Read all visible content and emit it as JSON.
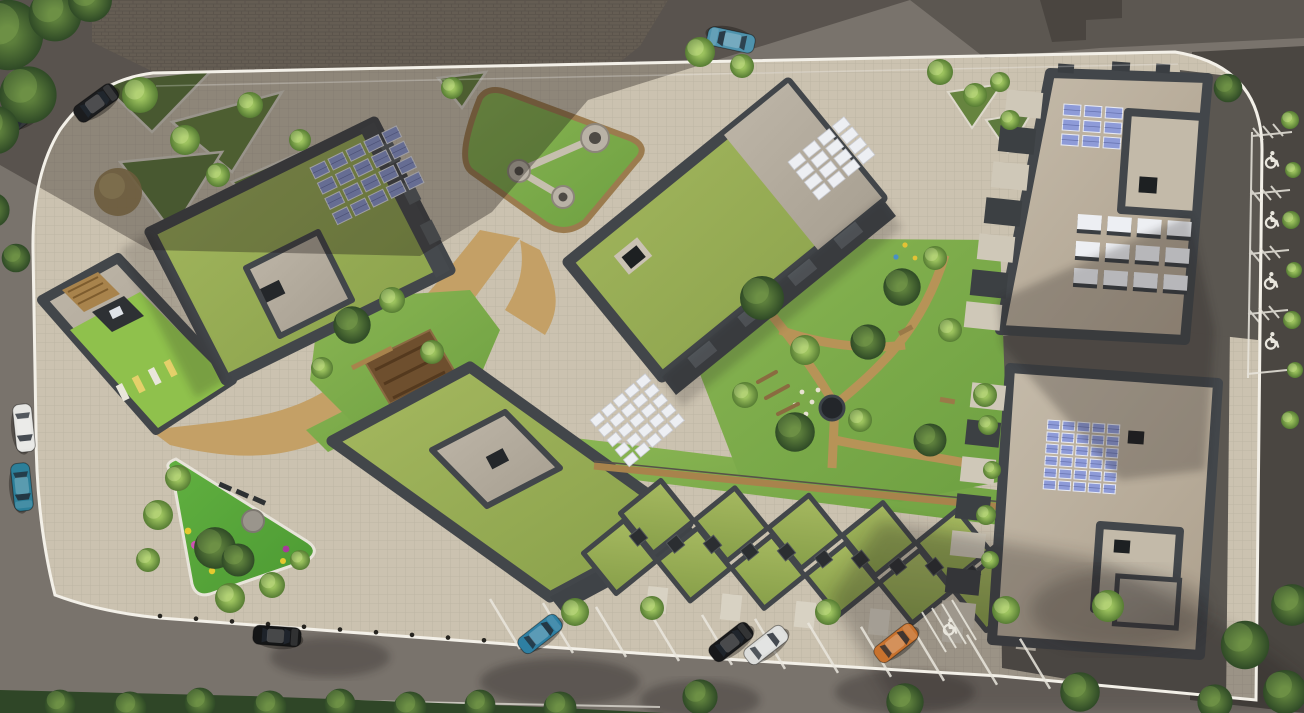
{
  "meta": {
    "title": "Top-down aerial rendering of a residential development site plan",
    "view": "orthographic top-down architectural visualization",
    "text_content": "none — image contains no readable text"
  },
  "palette": {
    "asphalt": "#79736c",
    "asphalt_dark": "#5b5751",
    "asphalt_deep": "#4a4641",
    "sidewalk_brick": "#8b8274",
    "plaza": "#cbc2b0",
    "parapet": "#42464a",
    "parapet_light": "#585d60",
    "path_tan": "#c4a066",
    "dirt": "#b08a52",
    "soil": "#6e4f2e",
    "wood": "#a8834c",
    "solar_blue": "#8e9bd8",
    "solar_frame": "#e6e9f4",
    "solar_white": "#edeff3",
    "white_line": "#eae7de",
    "boundary": "#f3f0e8",
    "hedge": "#2f4627",
    "flower_pink": "#cf52b5",
    "flower_magenta": "#a83a9a",
    "flower_yellow": "#e5c92f",
    "flower_lime": "#a6cf3a"
  },
  "scene": {
    "site": {
      "boundary_marking": "continuous white painted line around the parcel",
      "bollard_count": 11
    },
    "buildings": [
      {
        "name": "west-building",
        "roof": "extensive green roof",
        "solar_panels": "blue PV array 4x5",
        "extras": [
          "concrete roof courtyard with skylight",
          "roof terrace with timber deck",
          "lime lawn with 4 sun loungers"
        ]
      },
      {
        "name": "north-central-building",
        "roof": "green roof with concrete end bay",
        "solar_panels": "white PV array 4x4",
        "extras": [
          "black skylight",
          "balcony band on SE face"
        ]
      },
      {
        "name": "south-central-building",
        "roof": "green roof",
        "solar_panels": "white PV array 5x5",
        "extras": [
          "concrete roof courtyard with skylight"
        ]
      },
      {
        "name": "townhouse-row",
        "roof": "zigzag diamond green roofs",
        "units_upper": 6,
        "units_lower": 6,
        "extras": [
          "dark skylights at ridge joints",
          "timber boardwalk along rear"
        ]
      },
      {
        "name": "northeast-building",
        "roof": "concrete roof",
        "solar_panels": "blue PV array 3x3",
        "extras": [
          "rooftop monitor skylights 3x4",
          "penthouse volume with skylight",
          "balcony stack on west face"
        ]
      },
      {
        "name": "southeast-building",
        "roof": "concrete roof",
        "solar_panels": "blue PV array 6x5",
        "extras": [
          "penthouse volume with skylight",
          "balcony stack on west face"
        ]
      }
    ],
    "landscape": {
      "northwest_garden": "terraced planting beds with white edging and trees",
      "lawn_triangle": "rounded triangular lawn with three circular pads linked by paths",
      "central_garden": "informal play garden with dirt paths, log steps, benches and a sunken black trampoline",
      "community_garden": "raised soil planting beds with timber boardwalk",
      "playground_triangle": "bright green play triangle with pink/magenta/yellow/lime play dots, grey circle pad and benches",
      "street_greens": "tree islands in parking lane, hedge along south sidewalk, shrub strip along east kerb"
    },
    "parking": {
      "south_lane_stalls": 11,
      "accessible_spaces": 5,
      "marking_icon": "wheelchair-icon"
    },
    "cars": [
      {
        "name": "car-black-northwest",
        "x": 96,
        "y": 103,
        "angle": -36,
        "color": "#1b1c1e"
      },
      {
        "name": "car-gray-northwest",
        "x": 27,
        "y": 112,
        "angle": -36,
        "color": "#35383b"
      },
      {
        "name": "car-blue-north-road",
        "x": 731,
        "y": 40,
        "angle": -168,
        "color": "#4f93ad"
      },
      {
        "name": "car-white-west-road",
        "x": 24,
        "y": 428,
        "angle": 84,
        "color": "#e6e6e3"
      },
      {
        "name": "car-teal-west-road",
        "x": 22,
        "y": 487,
        "angle": 84,
        "color": "#2c7f99"
      },
      {
        "name": "car-black-south-road",
        "x": 277,
        "y": 636,
        "angle": 4,
        "color": "#141516"
      },
      {
        "name": "car-teal-parking",
        "x": 540,
        "y": 634,
        "angle": -38,
        "color": "#2e7fa2"
      },
      {
        "name": "car-black-parking",
        "x": 731,
        "y": 642,
        "angle": -38,
        "color": "#17181a"
      },
      {
        "name": "car-white-parking",
        "x": 766,
        "y": 645,
        "angle": -38,
        "color": "#dcdddb"
      },
      {
        "name": "car-orange-parking",
        "x": 896,
        "y": 643,
        "angle": -38,
        "color": "#c8722e"
      }
    ],
    "solar_arrays": [
      {
        "name": "pv-west-building",
        "x": 310,
        "y": 168,
        "angle": -26,
        "rows": 4,
        "cols": 5,
        "cw": 16,
        "ch": 12,
        "gx": 4,
        "gy": 5,
        "fill": "blue"
      },
      {
        "name": "pv-north-central",
        "x": 788,
        "y": 162,
        "angle": -39,
        "rows": 4,
        "cols": 4,
        "cw": 15,
        "ch": 10,
        "gx": 4,
        "gy": 3,
        "fill": "white"
      },
      {
        "name": "pv-south-central",
        "x": 590,
        "y": 420,
        "angle": -40,
        "rows": 5,
        "cols": 5,
        "cw": 12,
        "ch": 9,
        "gx": 3,
        "gy": 4,
        "fill": "white"
      },
      {
        "name": "pv-northeast-building",
        "x": 1064,
        "y": 104,
        "angle": 4,
        "rows": 3,
        "cols": 3,
        "cw": 17,
        "ch": 11,
        "gx": 4,
        "gy": 4,
        "fill": "blue"
      },
      {
        "name": "monitors-northeast",
        "x": 1078,
        "y": 214,
        "angle": 4,
        "rows": 3,
        "cols": 4,
        "cw": 24,
        "ch": 15,
        "gx": 6,
        "gy": 12,
        "fill": "monitor"
      },
      {
        "name": "pv-southeast-building",
        "x": 1048,
        "y": 420,
        "angle": 4,
        "rows": 6,
        "cols": 5,
        "cw": 12,
        "ch": 9,
        "gx": 3,
        "gy": 3,
        "fill": "blue"
      }
    ],
    "townhouses": {
      "size": 52,
      "pitch_x": 74,
      "pitch_y": 7.4,
      "skylight": 13,
      "upper": {
        "x": 657,
        "y": 517,
        "count": 6
      },
      "lower": {
        "x": 620,
        "y": 557,
        "count": 6
      }
    },
    "accessible_icons": [
      {
        "x": 1270,
        "y": 160
      },
      {
        "x": 1270,
        "y": 220
      },
      {
        "x": 1269,
        "y": 281
      },
      {
        "x": 1270,
        "y": 341
      },
      {
        "x": 948,
        "y": 627
      }
    ],
    "bollards": {
      "x0": 160,
      "y0": 616,
      "dx": 36,
      "dy": 2.7,
      "count": 11
    },
    "stall_lines": {
      "x0": 490,
      "y0": 599,
      "pitch": 53,
      "count": 11,
      "dx": 30,
      "dy": 50,
      "slope": 0.075
    }
  }
}
